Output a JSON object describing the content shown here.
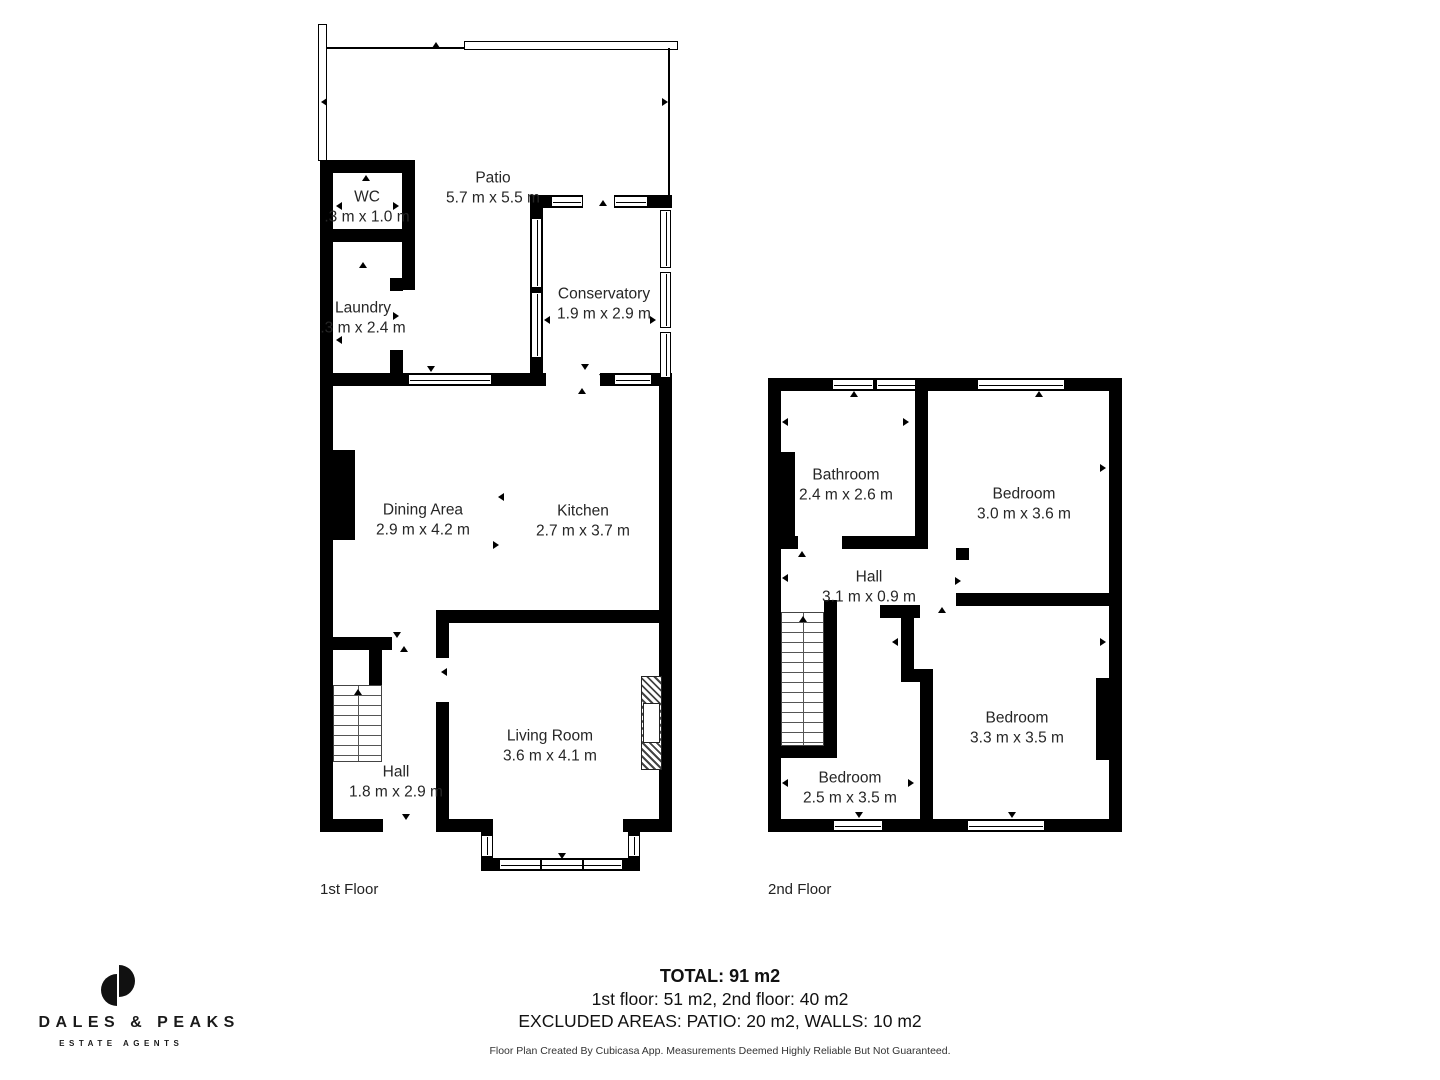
{
  "colors": {
    "wall": "#000000",
    "text": "#262626"
  },
  "floors": {
    "first": {
      "label": "1st Floor",
      "rooms": {
        "patio": {
          "name": "Patio",
          "dims": "5.7 m x 5.5 m"
        },
        "wc": {
          "name": "WC",
          "dims": ".3 m x 1.0 m"
        },
        "laundry": {
          "name": "Laundry",
          "dims": ".3 m x 2.4 m"
        },
        "conservatory": {
          "name": "Conservatory",
          "dims": "1.9 m x 2.9 m"
        },
        "dining": {
          "name": "Dining Area",
          "dims": "2.9 m x 4.2 m"
        },
        "kitchen": {
          "name": "Kitchen",
          "dims": "2.7 m x 3.7 m"
        },
        "hall": {
          "name": "Hall",
          "dims": "1.8 m x 2.9 m"
        },
        "living": {
          "name": "Living Room",
          "dims": "3.6 m x 4.1 m"
        }
      }
    },
    "second": {
      "label": "2nd Floor",
      "rooms": {
        "bathroom": {
          "name": "Bathroom",
          "dims": "2.4 m x 2.6 m"
        },
        "bedroom_top": {
          "name": "Bedroom",
          "dims": "3.0 m x 3.6 m"
        },
        "hall": {
          "name": "Hall",
          "dims": "3.1 m x 0.9 m"
        },
        "bedroom_left": {
          "name": "Bedroom",
          "dims": "2.5 m x 3.5 m"
        },
        "bedroom_right": {
          "name": "Bedroom",
          "dims": "3.3 m x 3.5 m"
        }
      }
    }
  },
  "summary": {
    "total": "TOTAL: 91 m2",
    "floors_line": "1st floor: 51 m2, 2nd floor: 40 m2",
    "excluded_line": "EXCLUDED AREAS: PATIO: 20 m2, WALLS: 10 m2",
    "disclaimer": "Floor Plan Created By Cubicasa App. Measurements Deemed Highly Reliable But Not Guaranteed."
  },
  "branding": {
    "name": "DALES & PEAKS",
    "tagline": "ESTATE AGENTS"
  }
}
